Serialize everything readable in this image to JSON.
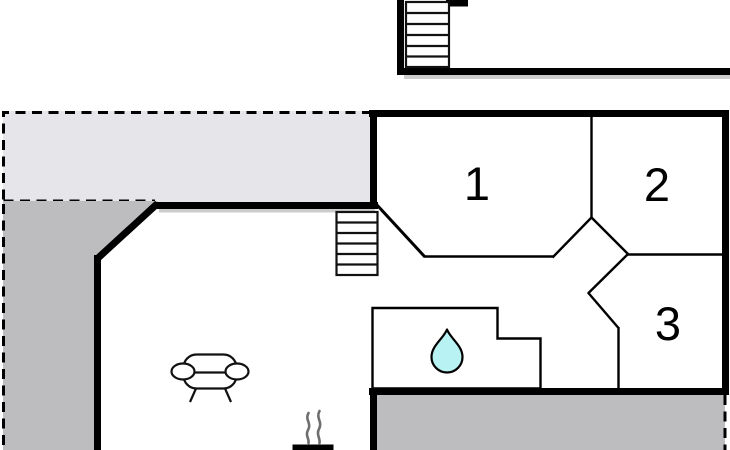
{
  "plan": {
    "type": "floor-plan",
    "rooms": [
      {
        "label": "1"
      },
      {
        "label": "2"
      },
      {
        "label": "3"
      }
    ]
  },
  "colors": {
    "wall": "#000000",
    "terrace_light": "#e6e6ea",
    "terrace_dark": "#bdbdbf",
    "water_drop": "#b9f2f2",
    "smoke": "#6e6e6e",
    "shadow": "#cccccc",
    "room_label": "#000000",
    "background": "#ffffff"
  },
  "icons": {
    "upper_staircase": "staircase-icon",
    "living_staircase": "staircase-icon",
    "sofa": "sofa-icon",
    "bathroom_drop": "water-drop-icon",
    "fireplace": "fireplace-icon"
  }
}
